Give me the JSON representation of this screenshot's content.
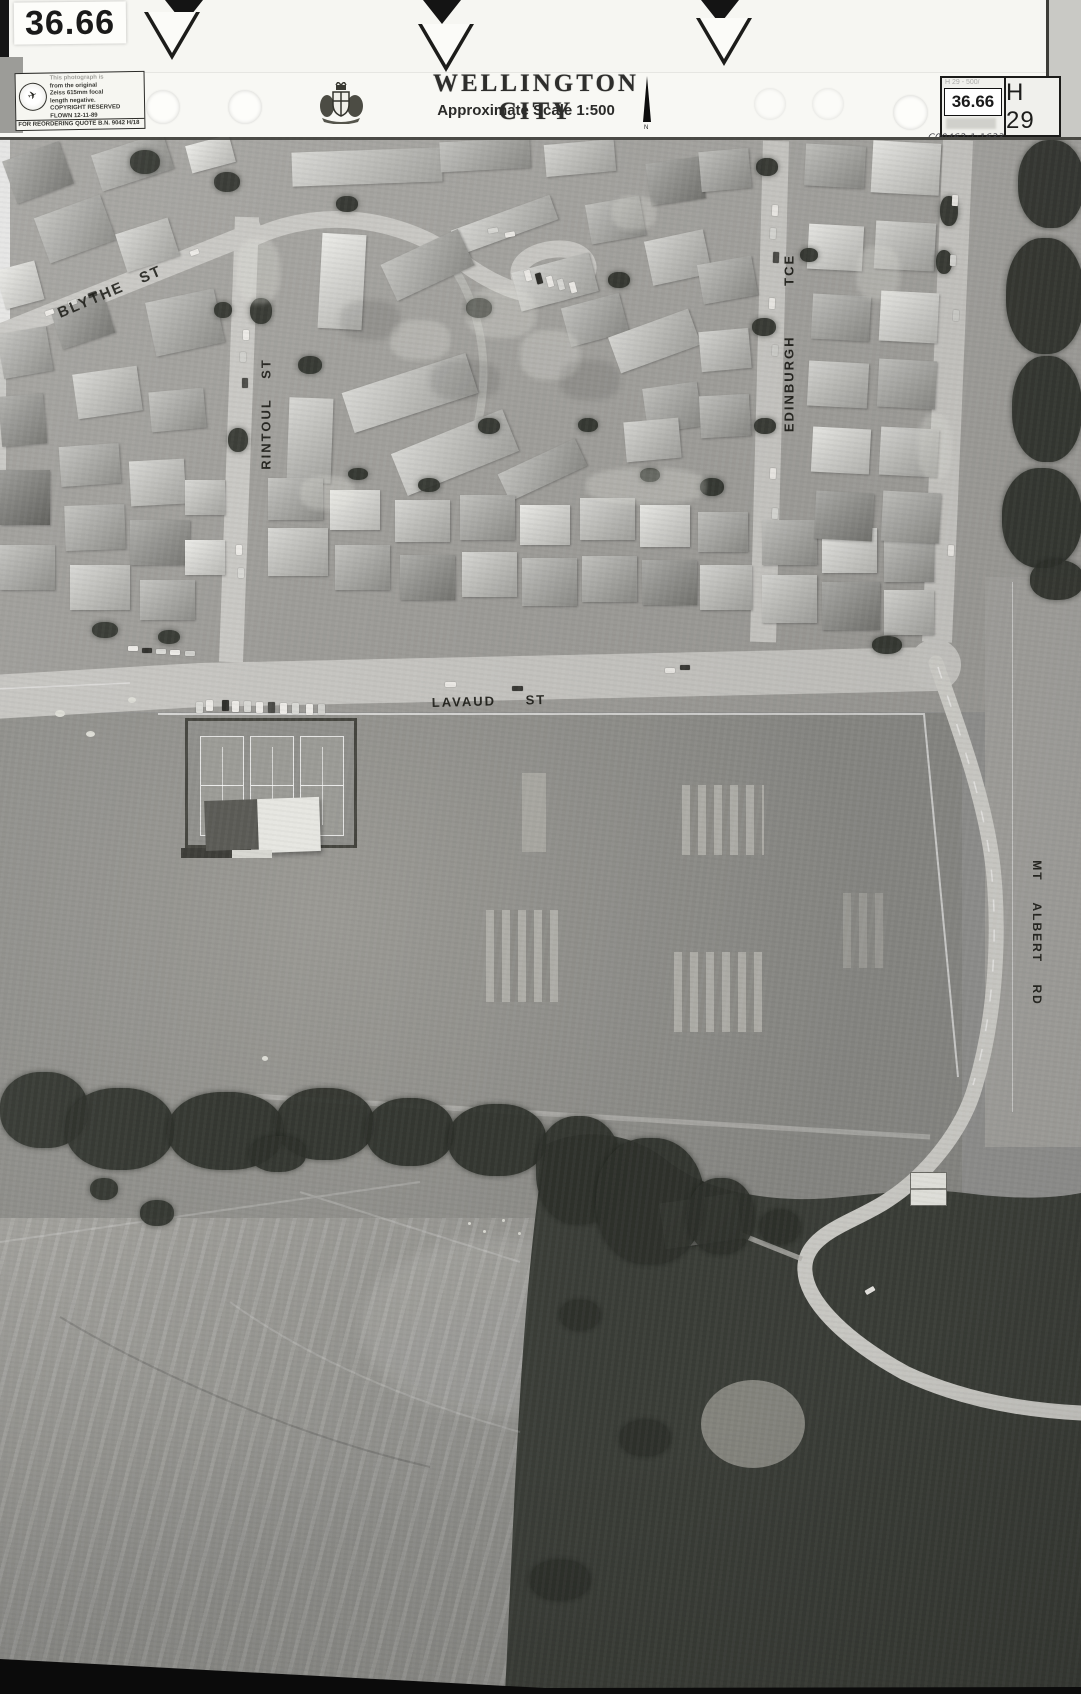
{
  "header": {
    "photo_id_label": "36.66",
    "title": "WELLINGTON CITY",
    "scale_note": "Approximate Scale 1:500",
    "north_label": "N",
    "stamp": {
      "lines": [
        "This photograph is",
        "from the original",
        "Zeiss 615mm focal",
        "length negative.",
        "COPYRIGHT RESERVED",
        "FLOWN 12-11-89"
      ],
      "footer": "FOR REORDERING QUOTE B.N. 9042  H/18"
    },
    "ref_box": {
      "faint_top": "H 29 - 500/",
      "number": "36.66",
      "sheet": "H 29"
    },
    "handwritten_code": "C00462:1:1633"
  },
  "map": {
    "street_labels": [
      {
        "name": "blythe-st",
        "text": "BLYTHE ST"
      },
      {
        "name": "rintoul-st",
        "text": "RINTOUL ST"
      },
      {
        "name": "edinburgh-tce",
        "text": "EDINBURGH TCE"
      },
      {
        "name": "lavaud-st",
        "text": "LAVAUD ST"
      },
      {
        "name": "mt-albert-rd",
        "text": "MT ALBERT RD"
      }
    ],
    "colors": {
      "road": "#c8c7c3",
      "field": "#8f8f8a",
      "vegetation": "#3c3f39",
      "label_ink": "#14140f"
    }
  }
}
